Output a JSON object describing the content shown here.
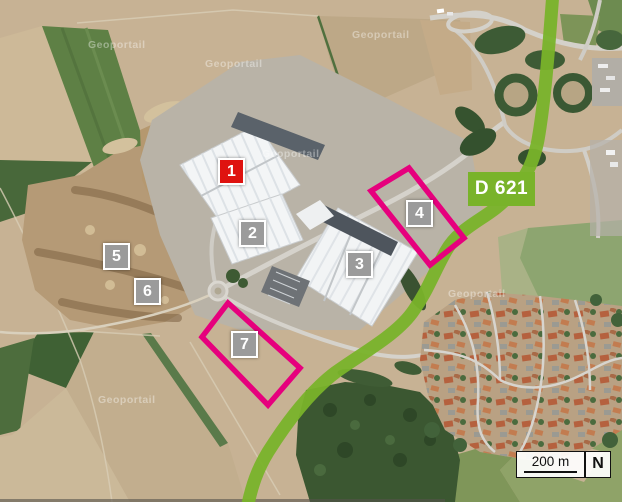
{
  "map": {
    "road_label": "D 621",
    "watermark": "Geoportail",
    "scale": {
      "label": "200 m",
      "north": "N"
    },
    "markers": [
      {
        "label": "1",
        "color": "#df1310"
      },
      {
        "label": "2",
        "color": "#9b9b9b"
      },
      {
        "label": "3",
        "color": "#9b9b9b"
      },
      {
        "label": "4",
        "color": "#9b9b9b"
      },
      {
        "label": "5",
        "color": "#9b9b9b"
      },
      {
        "label": "6",
        "color": "#9b9b9b"
      },
      {
        "label": "7",
        "color": "#9b9b9b"
      }
    ],
    "colors": {
      "route_overlay": "#79b32a",
      "highlight_zone": "#e6007d",
      "marker_red": "#df1310",
      "marker_gray": "#9b9b9b"
    }
  }
}
